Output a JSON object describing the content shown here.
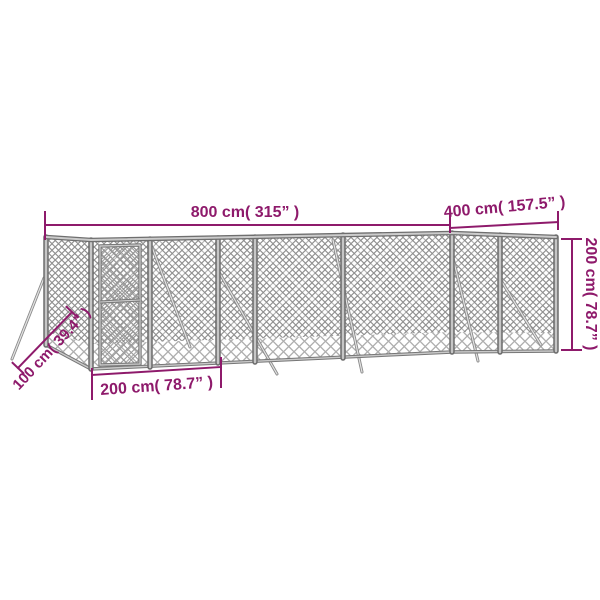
{
  "diagram": {
    "kind": "dog-kennel-dimension-diagram",
    "dimensions": {
      "total_width_label": "800 cm( 315” )",
      "total_depth_label": "400 cm( 157.5” )",
      "total_height_label": "200 cm( 78.7” )",
      "door_section_width_label": "200 cm( 78.7” )",
      "brace_length_label": "100 cm( 39.4” )"
    },
    "colors": {
      "annotation": "#8E1A6B",
      "mesh_dense": "#8f8f8f",
      "mesh_light": "#aeaeae",
      "frame": "#6f6f6f",
      "frame_highlight": "#c6c6c6",
      "background": "#ffffff"
    }
  }
}
